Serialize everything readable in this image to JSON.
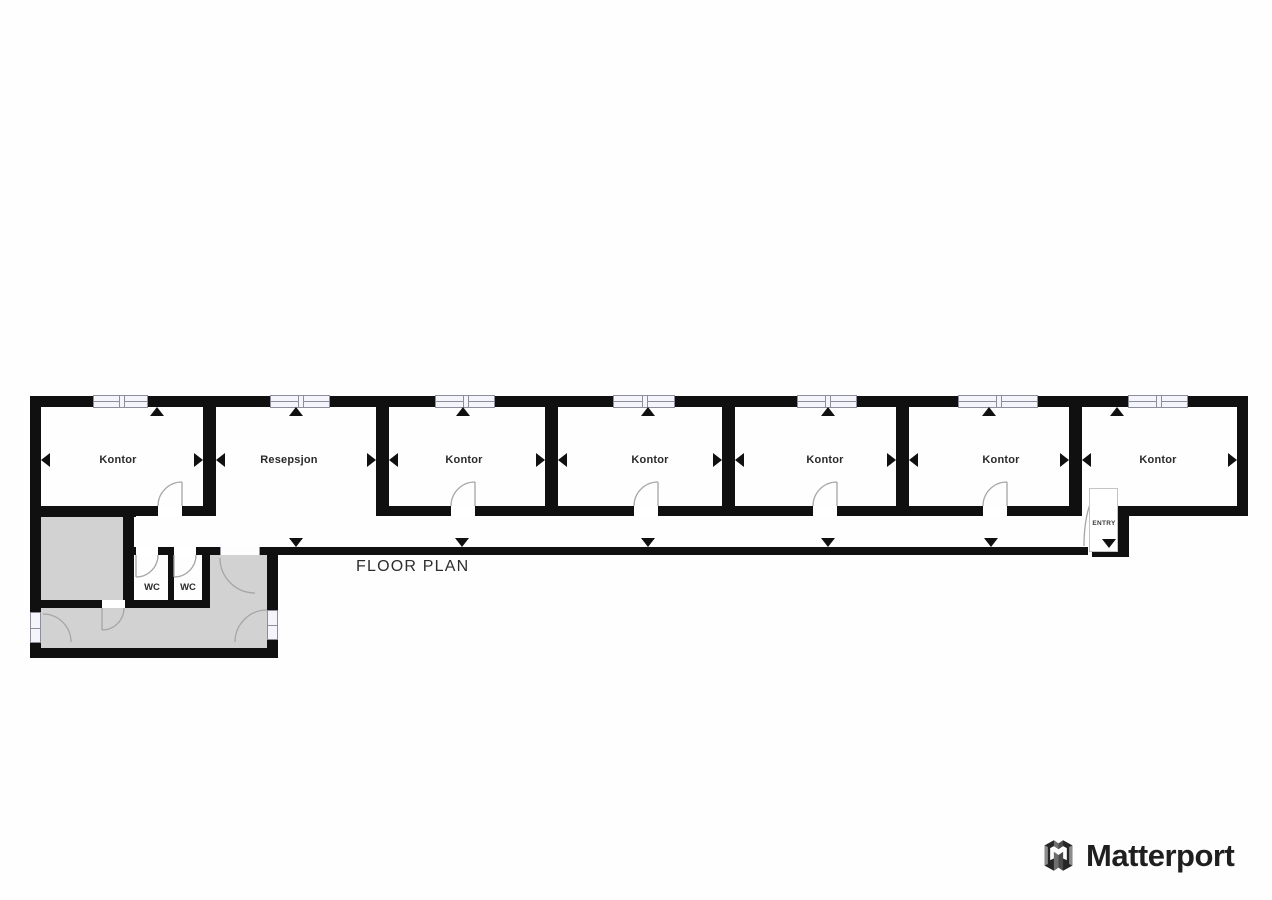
{
  "page": {
    "title": "FLOOR PLAN"
  },
  "floor_plan": {
    "rooms": [
      {
        "label": "Kontor"
      },
      {
        "label": "Resepsjon"
      },
      {
        "label": "Kontor"
      },
      {
        "label": "Kontor"
      },
      {
        "label": "Kontor"
      },
      {
        "label": "Kontor"
      },
      {
        "label": "Kontor"
      }
    ],
    "wc_rooms": [
      {
        "label": "WC"
      },
      {
        "label": "WC"
      }
    ],
    "entry_label": "ENTRY"
  },
  "branding": {
    "wordmark": "Matterport"
  },
  "colors": {
    "wall": "#101010",
    "secondary_room_fill": "#d2d2d2",
    "window_fill": "#f4f4fb",
    "door_arc": "#a6a6a6",
    "label_text": "#2a2a2a"
  }
}
